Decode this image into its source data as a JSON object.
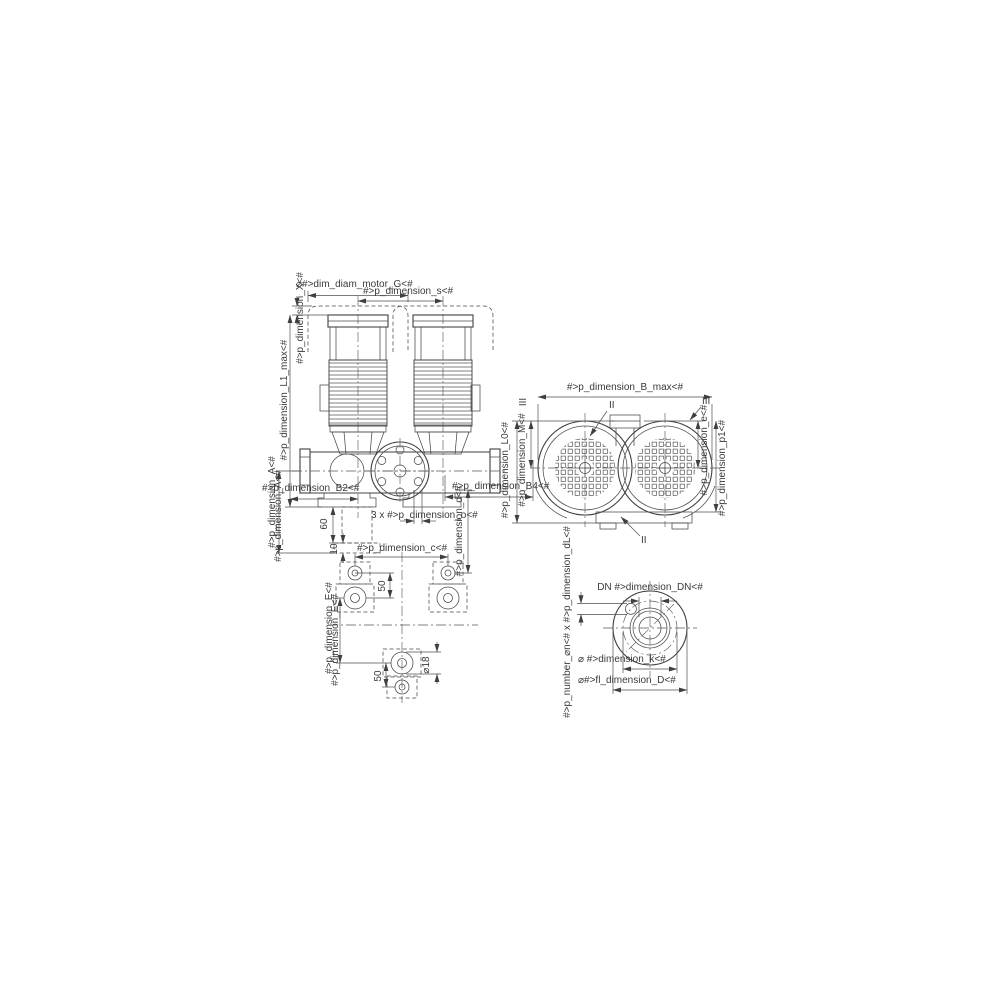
{
  "drawing": {
    "front_view": {
      "dim_motor_diam": "⌀#>dim_diam_motor_G<#",
      "dim_s": "#>p_dimension_s<#",
      "dim_X": "#>p_dimension_X<#",
      "dim_L1_max": "#>p_dimension_L1_max<#",
      "dim_A": "#>p_dimension_A<#",
      "dim_B2": "#>p_dimension_B2<#",
      "dim_60": "60",
      "dim_10": "10",
      "dim_holes_o": "3 x #>p_dimension_o<#",
      "dim_B4": "#>p_dimension_B4<#",
      "dim_d": "#>p_dimension_d<#"
    },
    "motor_end_view": {
      "dim_B_max": "#>p_dimension_B_max<#",
      "dim_L0": "#>p_dimension_L0<#",
      "dim_M": "#>p_dimension_M<#",
      "dim_e": "#>p_dimension_e<#",
      "dim_p1": "#>p_dimension_p1<#",
      "marker_II": "II",
      "marker_III": "III"
    },
    "foundation_view": {
      "dim_c": "#>p_dimension_c<#",
      "dim_50_top": "50",
      "dim_50_bottom": "50",
      "dim_hole_diam": "⌀18",
      "dim_E": "#>p_dimension_E<#"
    },
    "flange_view": {
      "dim_DN": "DN #>dimension_DN<#",
      "dim_k": "⌀ #>dimension_k<#",
      "dim_D": "⌀#>fl_dimension_D<#",
      "dim_bolt_holes": "#>p_number_⌀n<# x #>p_dimension_dL<#"
    }
  }
}
